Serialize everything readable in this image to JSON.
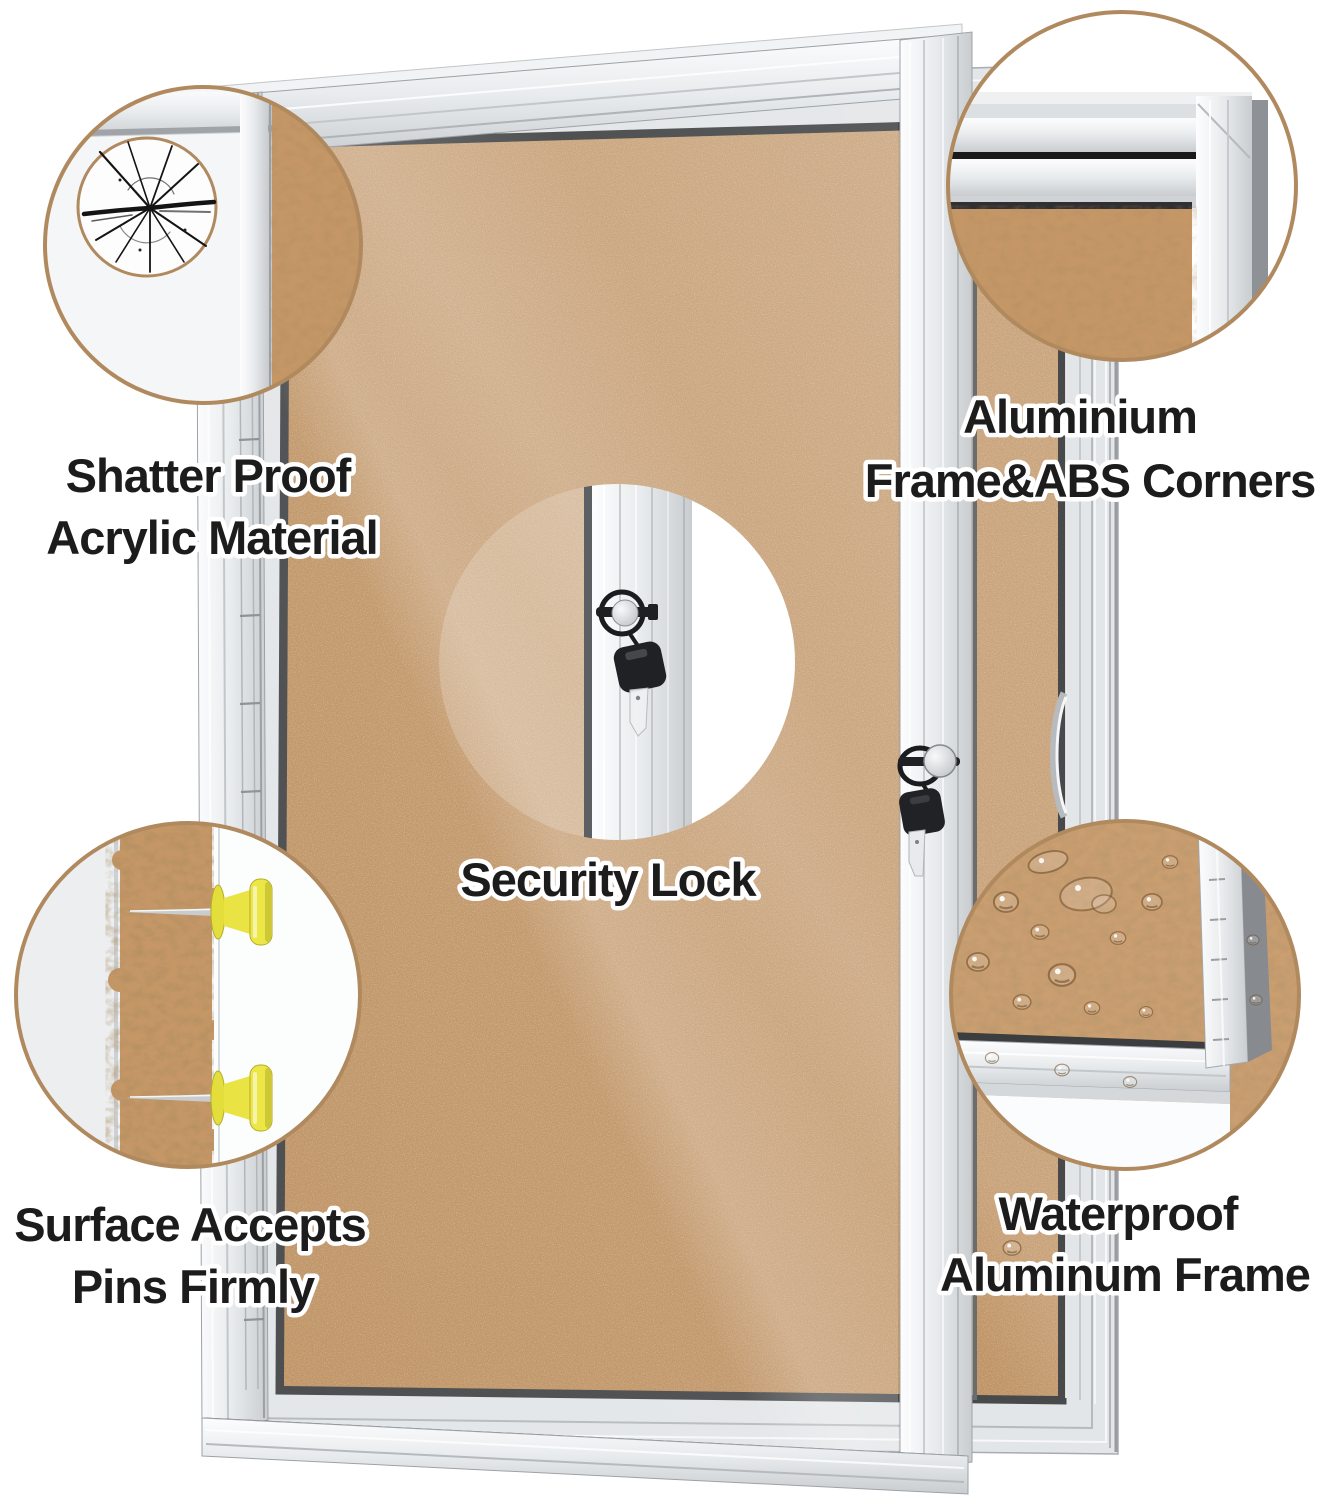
{
  "callouts": {
    "shatter_proof": {
      "line1": "Shatter Proof",
      "line2": "Acrylic Material"
    },
    "aluminium_frame": {
      "line1": "Aluminium",
      "line2": "Frame&ABS Corners"
    },
    "security_lock": {
      "line1": "Security Lock"
    },
    "surface_pins": {
      "line1": "Surface Accepts",
      "line2": "Pins Firmly"
    },
    "waterproof": {
      "line1": "Waterproof",
      "line2": "Aluminum Frame"
    }
  },
  "colors": {
    "ink": "#1c1c1c",
    "outline": "#ffffff",
    "circle-border": "#b08a5e",
    "cork": "#c59767",
    "cork-light": "#d2ab80",
    "frame-silver": "#e3e6e8",
    "pin-yellow": "#e7e142",
    "key-black": "#1d1e20"
  }
}
